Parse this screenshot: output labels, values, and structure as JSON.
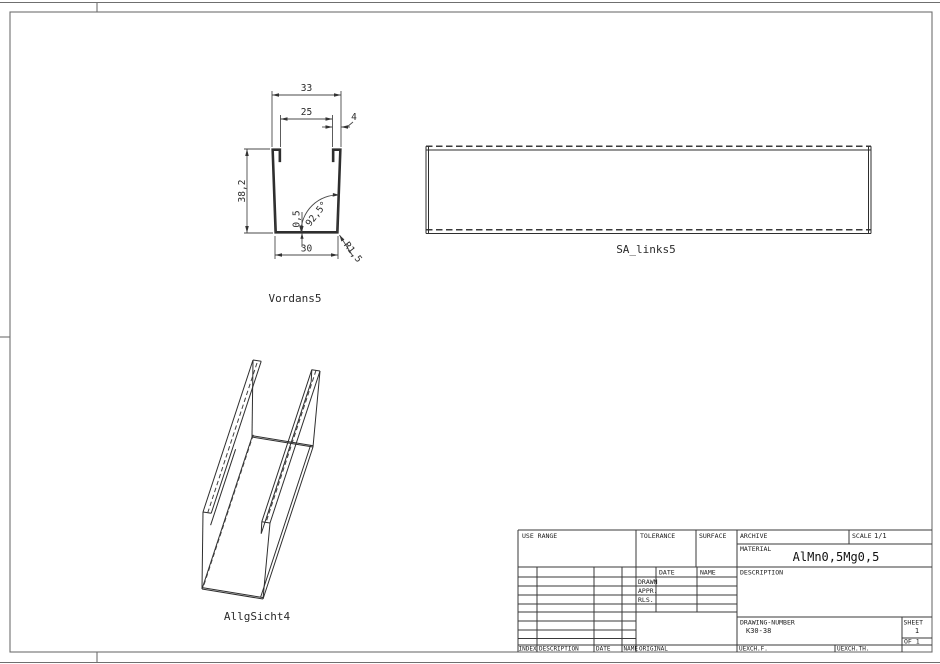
{
  "page": {
    "background": "#ffffff",
    "line_color": "#4a4a4a"
  },
  "views": {
    "front": {
      "label": "Vordans5",
      "dimensions": {
        "top_width": "33",
        "opening_width": "25",
        "flange_width": "4",
        "height": "38,2",
        "bottom_width": "30",
        "thickness": "0,5",
        "wall_angle": "92,5°",
        "corner_radius": "R1,5"
      }
    },
    "side": {
      "label": "SA_links5"
    },
    "iso": {
      "label": "AllgSicht4"
    }
  },
  "title_block": {
    "use_range": "USE RANGE",
    "tolerance": "TOLERANCE",
    "surface": "SURFACE",
    "archive": "ARCHIVE",
    "scale_label": "SCALE",
    "scale_value": "1/1",
    "material_label": "MATERIAL",
    "material_value": "AlMn0,5Mg0,5",
    "date": "DATE",
    "name": "NAME",
    "drawn": "DRAWN",
    "appr": "APPR.",
    "rls": "RLS.",
    "description": "DESCRIPTION",
    "drawing_number_label": "DRAWING-NUMBER",
    "drawing_number_value": "K30-38",
    "sheet_label": "SHEET",
    "sheet_value": "1",
    "of_value": "OF 1",
    "index": "INDEX",
    "row_description": "DESCRIPTION",
    "row_date": "DATE",
    "row_name": "NAME",
    "original": "ORIGINAL",
    "uexch_f": "UEXCH.F.",
    "uexch_th": "UEXCH.TH."
  }
}
